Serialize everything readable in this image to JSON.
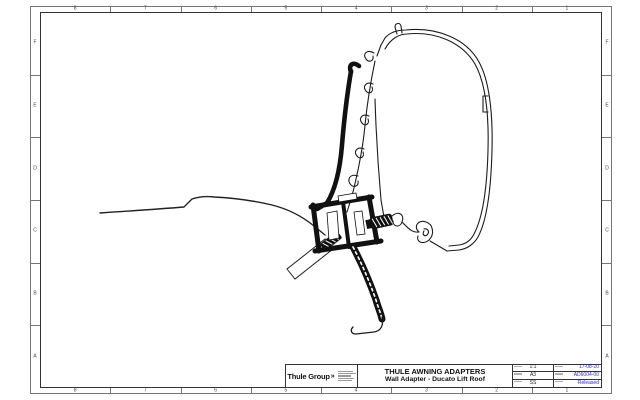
{
  "sheet": {
    "grid": {
      "columns": [
        "8",
        "7",
        "6",
        "5",
        "4",
        "3",
        "2",
        "1"
      ],
      "rows": [
        "F",
        "E",
        "D",
        "C",
        "B",
        "A"
      ]
    },
    "title_block": {
      "logo_text": "Thule Group",
      "logo_mark": "»",
      "title_line1": "THULE AWNING ADAPTERS",
      "title_line2": "Wall Adapter - Ducato Lift Roof",
      "scale": "1:1",
      "format": "A3",
      "initials": "SS",
      "date": "17-08-20",
      "document_number": "AD6004-00",
      "status": "Released",
      "status_color": "#2a2ac0"
    },
    "drawing": {
      "description": "Cross-section technical drawing: Thule awning case profile (thin outline), wall adapter bracket (thick black profile) and Ducato lift-roof contour (thin line)",
      "line_color": "#1a1a1a"
    }
  }
}
